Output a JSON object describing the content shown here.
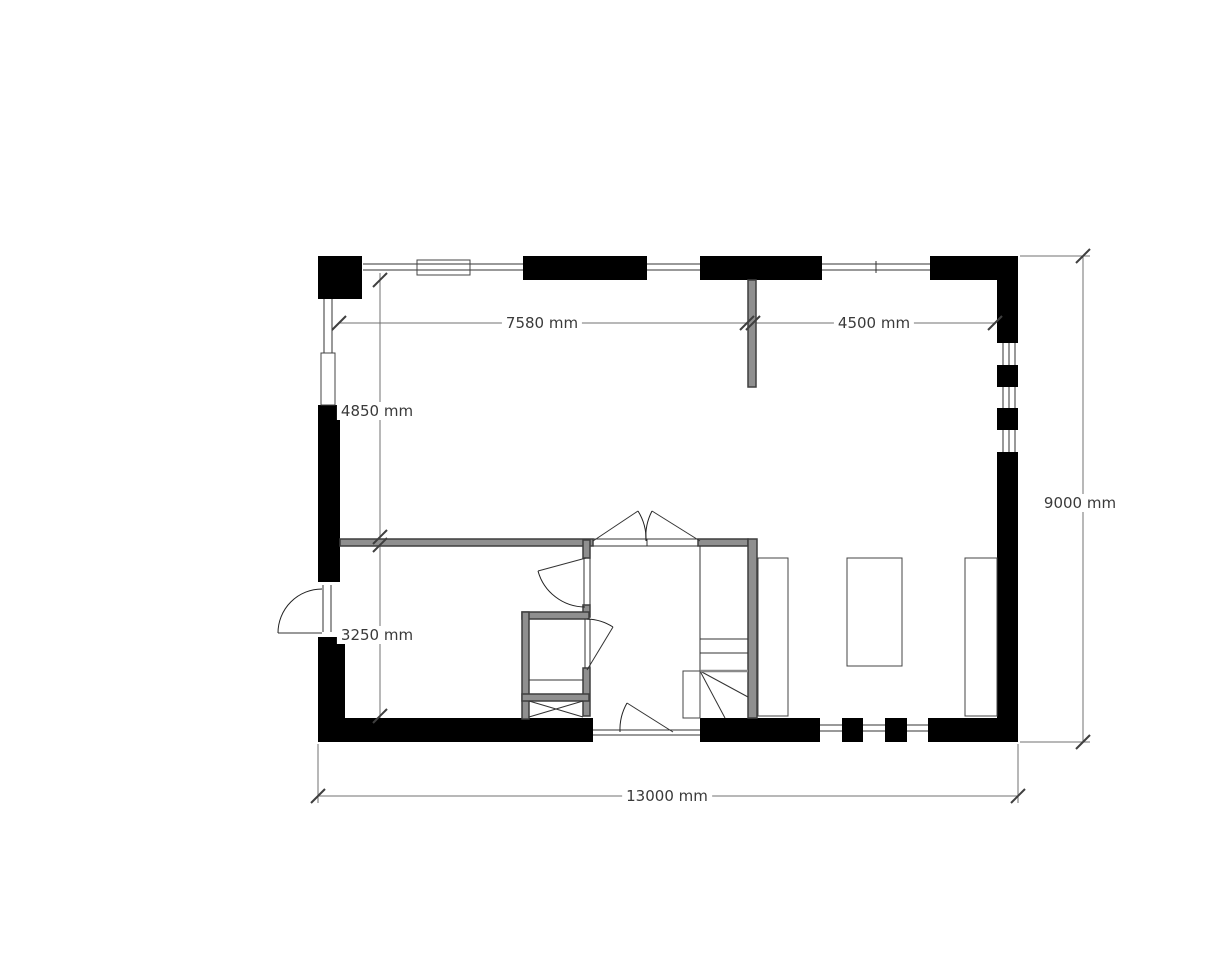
{
  "plan": {
    "type": "floor-plan",
    "unit": "mm",
    "dimensions": {
      "top_left_span": {
        "value": 7580,
        "label": "7580 mm"
      },
      "top_right_span": {
        "value": 4500,
        "label": "4500 mm"
      },
      "left_upper_span": {
        "value": 4850,
        "label": "4850 mm"
      },
      "left_lower_span": {
        "value": 3250,
        "label": "3250 mm"
      },
      "right_span": {
        "value": 9000,
        "label": "9000 mm"
      },
      "bottom_span": {
        "value": 13000,
        "label": "13000 mm"
      }
    },
    "colors": {
      "exterior_wall": "#000000",
      "interior_wall_fill": "#8f8f8f",
      "interior_wall_edge": "#3f3f3f",
      "thin_line": "#333333",
      "dim_line": "#707070",
      "tick": "#3f3f3f",
      "text": "#3a3a3a"
    },
    "geometry": {
      "black_rects": [
        [
          318,
          256,
          44,
          43
        ],
        [
          523,
          256,
          124,
          24
        ],
        [
          700,
          256,
          122,
          24
        ],
        [
          930,
          256,
          88,
          24
        ],
        [
          997,
          280,
          21,
          63
        ],
        [
          997,
          365,
          21,
          22
        ],
        [
          997,
          408,
          21,
          22
        ],
        [
          997,
          452,
          21,
          290
        ],
        [
          318,
          405,
          22,
          177
        ],
        [
          318,
          637,
          27,
          105
        ],
        [
          318,
          718,
          275,
          24
        ],
        [
          700,
          718,
          120,
          24
        ],
        [
          842,
          718,
          21,
          24
        ],
        [
          885,
          718,
          22,
          24
        ],
        [
          928,
          718,
          90,
          24
        ]
      ],
      "wall_rects": [
        [
          340,
          539,
          253,
          7
        ],
        [
          698,
          539,
          50,
          7
        ],
        [
          748,
          539,
          9,
          179
        ],
        [
          748,
          280,
          8,
          107
        ],
        [
          583,
          540,
          7,
          18
        ],
        [
          583,
          605,
          7,
          12
        ],
        [
          583,
          668,
          7,
          48
        ],
        [
          522,
          612,
          67,
          7
        ],
        [
          522,
          612,
          7,
          107
        ],
        [
          522,
          694,
          67,
          7
        ]
      ],
      "thin_rects": [
        [
          417,
          260,
          53,
          15
        ],
        [
          321,
          353,
          14,
          52
        ],
        [
          683,
          671,
          17,
          47
        ],
        [
          758,
          558,
          30,
          158
        ],
        [
          847,
          558,
          55,
          108
        ],
        [
          965,
          558,
          32,
          158
        ]
      ],
      "lines": [
        [
          363,
          264,
          523,
          264
        ],
        [
          363,
          270,
          523,
          270
        ],
        [
          647,
          264,
          700,
          264
        ],
        [
          647,
          270,
          700,
          270
        ],
        [
          822,
          264,
          930,
          264
        ],
        [
          822,
          270,
          930,
          270
        ],
        [
          876,
          261,
          876,
          273
        ],
        [
          324,
          299,
          324,
          353
        ],
        [
          332,
          299,
          332,
          353
        ],
        [
          1003,
          343,
          1003,
          365
        ],
        [
          1009,
          343,
          1009,
          365
        ],
        [
          1015,
          343,
          1015,
          365
        ],
        [
          1003,
          387,
          1003,
          408
        ],
        [
          1009,
          387,
          1009,
          408
        ],
        [
          1015,
          387,
          1015,
          408
        ],
        [
          1003,
          430,
          1003,
          452
        ],
        [
          1009,
          430,
          1009,
          452
        ],
        [
          1015,
          430,
          1015,
          452
        ],
        [
          820,
          725,
          842,
          725
        ],
        [
          820,
          731,
          842,
          731
        ],
        [
          863,
          725,
          885,
          725
        ],
        [
          863,
          731,
          885,
          731
        ],
        [
          907,
          725,
          928,
          725
        ],
        [
          907,
          731,
          928,
          731
        ],
        [
          593,
          730,
          700,
          730
        ],
        [
          593,
          735,
          700,
          735
        ],
        [
          323,
          585,
          323,
          632
        ],
        [
          331,
          585,
          331,
          632
        ],
        [
          584,
          558,
          584,
          605
        ],
        [
          590,
          558,
          590,
          605
        ],
        [
          585,
          619,
          585,
          668
        ],
        [
          590,
          619,
          590,
          668
        ],
        [
          593,
          539,
          698,
          539
        ],
        [
          593,
          546,
          698,
          546
        ],
        [
          647,
          539,
          647,
          546
        ],
        [
          529,
          680,
          583,
          680
        ],
        [
          529,
          701,
          583,
          717
        ],
        [
          529,
          717,
          583,
          701
        ],
        [
          700,
          546,
          700,
          718
        ],
        [
          700,
          639,
          748,
          639
        ],
        [
          700,
          653,
          748,
          653
        ],
        [
          700,
          671,
          748,
          697
        ],
        [
          700,
          671,
          725,
          718
        ],
        [
          586,
          558,
          538,
          571
        ],
        [
          587,
          670,
          613,
          627
        ],
        [
          673,
          732,
          627,
          703
        ],
        [
          278,
          633,
          322,
          633
        ],
        [
          593,
          541,
          638,
          511
        ],
        [
          700,
          541,
          652,
          511
        ]
      ],
      "gray_lines": [
        [
          700,
          671,
          748,
          671
        ]
      ],
      "arcs": [
        "M 322,589 A 44,44 0 0 0 278,633",
        "M 538,571 A 49,49 0 0 0 585,607",
        "M 587,619 A 51,51 0 0 1 613,627",
        "M 620,732 A 54,54 0 0 1 627,703",
        "M 646,541 A 53,53 0 0 0 638,511",
        "M 646,541 A 55,55 0 0 1 652,511"
      ],
      "dim_lines": [
        [
          339,
          323,
          995,
          323
        ],
        [
          380,
          273,
          380,
          718
        ],
        [
          1083,
          256,
          1083,
          742
        ],
        [
          318,
          796,
          1018,
          796
        ],
        [
          1020,
          256,
          1090,
          256
        ],
        [
          1020,
          742,
          1090,
          742
        ],
        [
          318,
          744,
          318,
          803
        ],
        [
          1018,
          744,
          1018,
          803
        ]
      ],
      "ticks": [
        [
          339,
          323
        ],
        [
          747,
          323
        ],
        [
          753,
          323
        ],
        [
          995,
          323
        ],
        [
          380,
          280
        ],
        [
          380,
          537
        ],
        [
          380,
          545
        ],
        [
          380,
          716
        ],
        [
          1083,
          256
        ],
        [
          1083,
          742
        ],
        [
          318,
          796
        ],
        [
          1018,
          796
        ]
      ]
    }
  }
}
